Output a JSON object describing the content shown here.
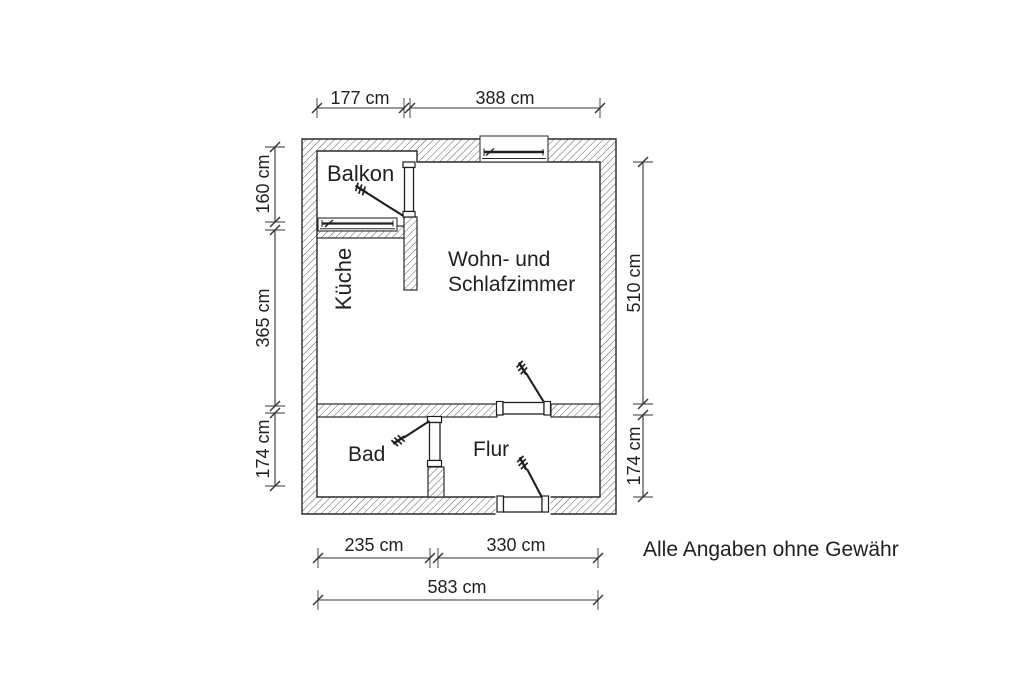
{
  "plan": {
    "rooms": {
      "balkon": "Balkon",
      "kueche": "Küche",
      "wohnzimmer_line1": "Wohn- und",
      "wohnzimmer_line2": "Schlafzimmer",
      "bad": "Bad",
      "flur": "Flur"
    },
    "dimensions": {
      "top_left_width": "177 cm",
      "top_right_width": "388 cm",
      "left_balkon_height": "160 cm",
      "left_kueche_height": "365 cm",
      "left_bad_height": "174 cm",
      "right_wohnzimmer_height": "510 cm",
      "right_flur_height": "174 cm",
      "bottom_bad_width": "235 cm",
      "bottom_flur_width": "330 cm",
      "bottom_total_width": "583 cm"
    },
    "disclaimer": "Alle Angaben ohne Gewähr",
    "colors": {
      "ink": "#1f1f1f",
      "paper": "#ffffff"
    }
  }
}
